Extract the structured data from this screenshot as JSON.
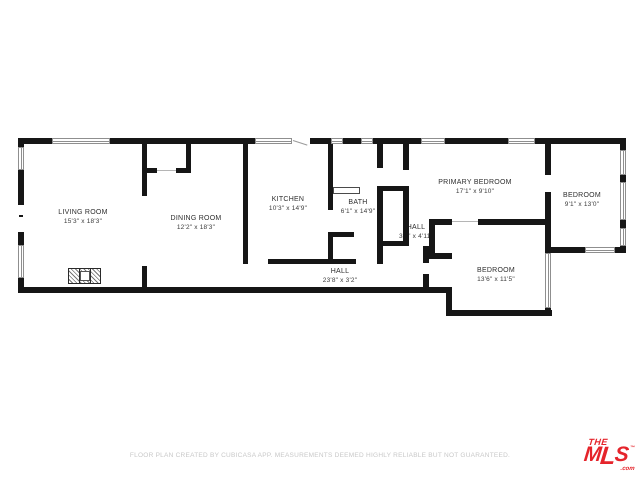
{
  "floorplan": {
    "wall_color": "#161616",
    "rooms": [
      {
        "name": "LIVING ROOM",
        "dims": "15'3\" x 18'3\""
      },
      {
        "name": "DINING ROOM",
        "dims": "12'2\" x 18'3\""
      },
      {
        "name": "KITCHEN",
        "dims": "10'3\" x 14'9\""
      },
      {
        "name": "BATH",
        "dims": "6'1\" x 14'9\""
      },
      {
        "name": "HALL",
        "dims": "3'3\" x 4'11\""
      },
      {
        "name": "PRIMARY BEDROOM",
        "dims": "17'1\" x 9'10\""
      },
      {
        "name": "BEDROOM",
        "dims": "9'1\" x 13'0\""
      },
      {
        "name": "BEDROOM",
        "dims": "13'6\" x 11'5\""
      },
      {
        "name": "HALL",
        "dims": "23'8\" x 3'2\""
      }
    ]
  },
  "footer": {
    "disclaimer": "FLOOR PLAN CREATED BY CUBICASA APP. MEASUREMENTS DEEMED HIGHLY RELIABLE BUT NOT GUARANTEED."
  },
  "logo": {
    "the": "THE",
    "mls": "MLS",
    "m": "M",
    "l": "L",
    "s": "S",
    "tm": "™",
    "com": ".com",
    "color": "#e5242b"
  }
}
